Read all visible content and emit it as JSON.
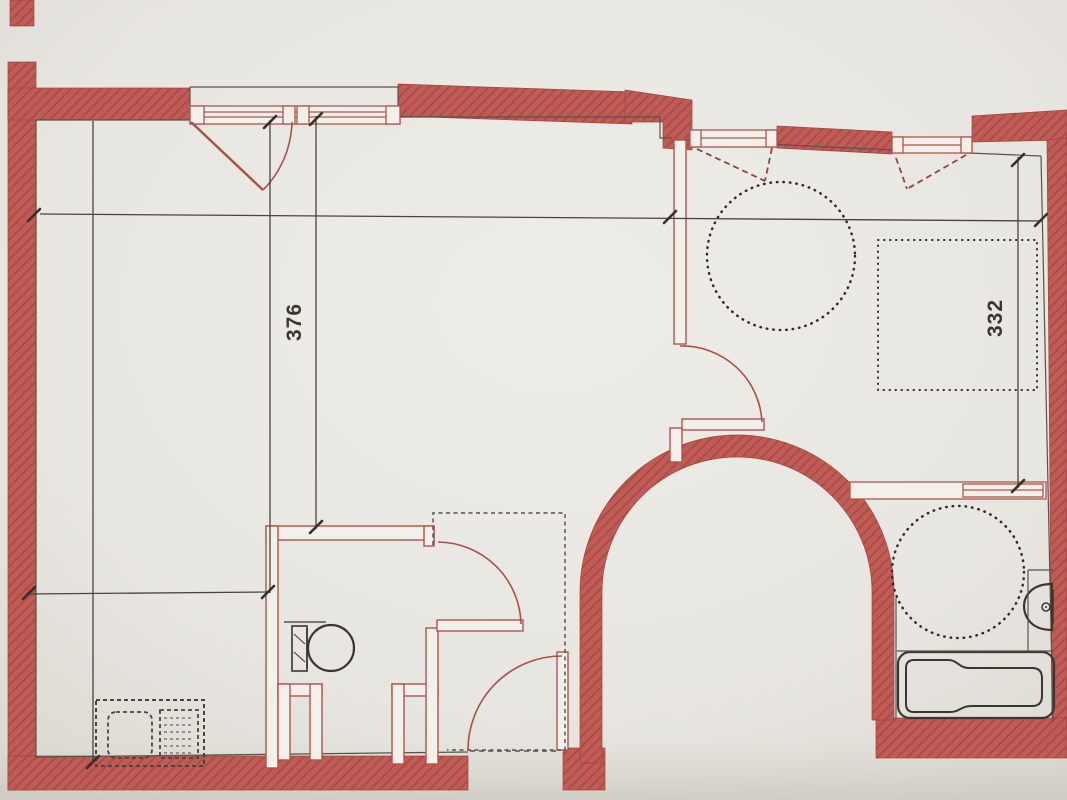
{
  "photo": {
    "type": "floor-plan-photo",
    "description": "Photograph of an architectural floor plan drawn with red walls on light paper"
  },
  "dimension_labels": {
    "left": {
      "label": "376",
      "orientation": "vertical"
    },
    "right": {
      "label": "332",
      "orientation": "vertical"
    }
  },
  "colors": {
    "wall_red": "#c15b55",
    "wall_hatch": "#ad4d48",
    "line_red": "#b0544e",
    "ink": "#3c3631",
    "dotted_ink": "#332d26",
    "paper": "#e9e8e3"
  },
  "symbols": {
    "fixtures": [
      "toilet",
      "bathtub",
      "washbasin",
      "kitchen-unit-dashed"
    ],
    "annotations": [
      "turning-circle",
      "turning-circle",
      "furniture-dotted-outline",
      "door-swing-arc",
      "window-opening-dashed",
      "dimension-line"
    ]
  }
}
